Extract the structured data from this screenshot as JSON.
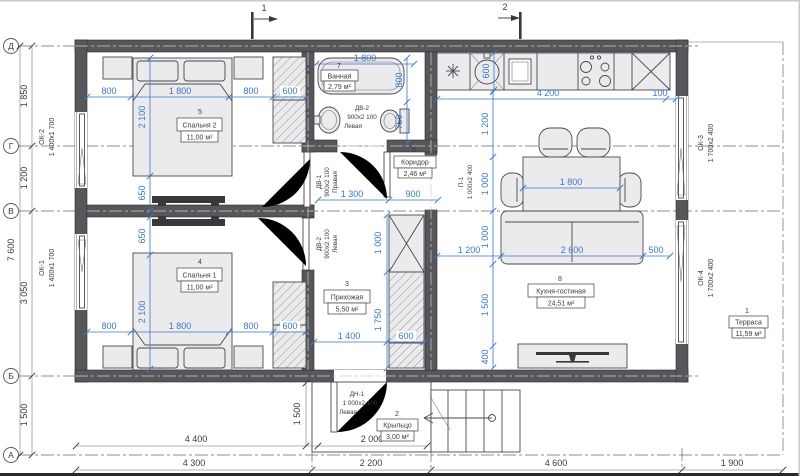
{
  "drawing": {
    "section_marks": {
      "m1": "1",
      "m2": "2"
    },
    "axis_labels": {
      "a5": "Д",
      "a4": "Г",
      "a3": "В",
      "a2": "Б",
      "a1": "А"
    },
    "outer_dims": {
      "total_height": "7 600",
      "seg_d_g": "1 850",
      "seg_g_v": "1 200",
      "seg_v_b": "3 050",
      "seg_b_a": "1 500",
      "porch_depth": "1 500",
      "row1_left": "4 400",
      "row1_porch": "2 000",
      "row2_c1": "4 300",
      "row2_c2": "2 200",
      "row2_c3": "4 600",
      "row2_c4": "1 900"
    },
    "windows": {
      "ok2": {
        "code": "ОК-2",
        "size": "1 400х1 700"
      },
      "ok1": {
        "code": "ОК-1",
        "size": "1 400х1 700"
      },
      "ok3": {
        "code": "ОК-3",
        "size": "1 700х2 400"
      },
      "ok4": {
        "code": "ОК-4",
        "size": "1 700х2 400"
      }
    },
    "doors": {
      "dv1": {
        "code": "ДВ-1",
        "size": "900х2 100",
        "hand": "Правая"
      },
      "dv2a": {
        "code": "ДВ-2",
        "size": "900х2 100",
        "hand": "Левая"
      },
      "dv2b": {
        "code": "ДВ-2",
        "size": "900х2 100",
        "hand": "Левая"
      },
      "dn1": {
        "code": "ДН-1",
        "size": "1 000х2 100",
        "hand": "Левая"
      },
      "p1": {
        "code": "П-1",
        "size": "1 000х2 400"
      }
    },
    "rooms": {
      "terrace": {
        "num": "1",
        "name": "Терраса",
        "area": "11,59 м²"
      },
      "porch": {
        "num": "2",
        "name": "Крыльцо",
        "area": "3,00 м²"
      },
      "hall": {
        "num": "3",
        "name": "Прихожая",
        "area": "5,50 м²"
      },
      "bedroom1": {
        "num": "4",
        "name": "Спальня 1",
        "area": "11,00 м²"
      },
      "bedroom2": {
        "num": "5",
        "name": "Спальня 2",
        "area": "11,00 м²"
      },
      "corridor": {
        "num": "6",
        "name": "Коридор",
        "area": "2,46 м²"
      },
      "bath": {
        "num": "7",
        "name": "Ванная",
        "area": "2,79 м²"
      },
      "kitchen": {
        "num": "8",
        "name": "Кухня-гостиная",
        "area": "24,51 м²"
      }
    },
    "dims": {
      "b2_left": "800",
      "b2_bed": "1 800",
      "b2_right": "800",
      "b2_ward": "600",
      "b2_len": "2 100",
      "b2_gap": "650",
      "b1_gap": "650",
      "b1_len": "2 100",
      "b1_left": "800",
      "b1_bed": "1 800",
      "b1_right": "800",
      "b1_ward": "600",
      "bath_len": "1 800",
      "bath_w": "800",
      "wc_w": "750",
      "cor_len": "1 300",
      "cor_w": "900",
      "closet": "1 000",
      "hall_ward": "1 750",
      "hall_w": "1 400",
      "hall_ward_w": "600",
      "kit_depth": "600",
      "kit_run": "4 200",
      "kit_gap": "100",
      "kit_v1": "1 200",
      "table_len": "1 000",
      "table_w": "1 800",
      "sofa_d": "1 000",
      "kit_v2": "1 500",
      "tv_d": "400",
      "kit_h1": "1 200",
      "sofa_w": "2 600",
      "kit_h2": "500"
    },
    "colors": {
      "wall": "#57575b",
      "dim_blue": "#3a77c4",
      "furniture": "#ebebee",
      "background": "#ffffff"
    }
  }
}
